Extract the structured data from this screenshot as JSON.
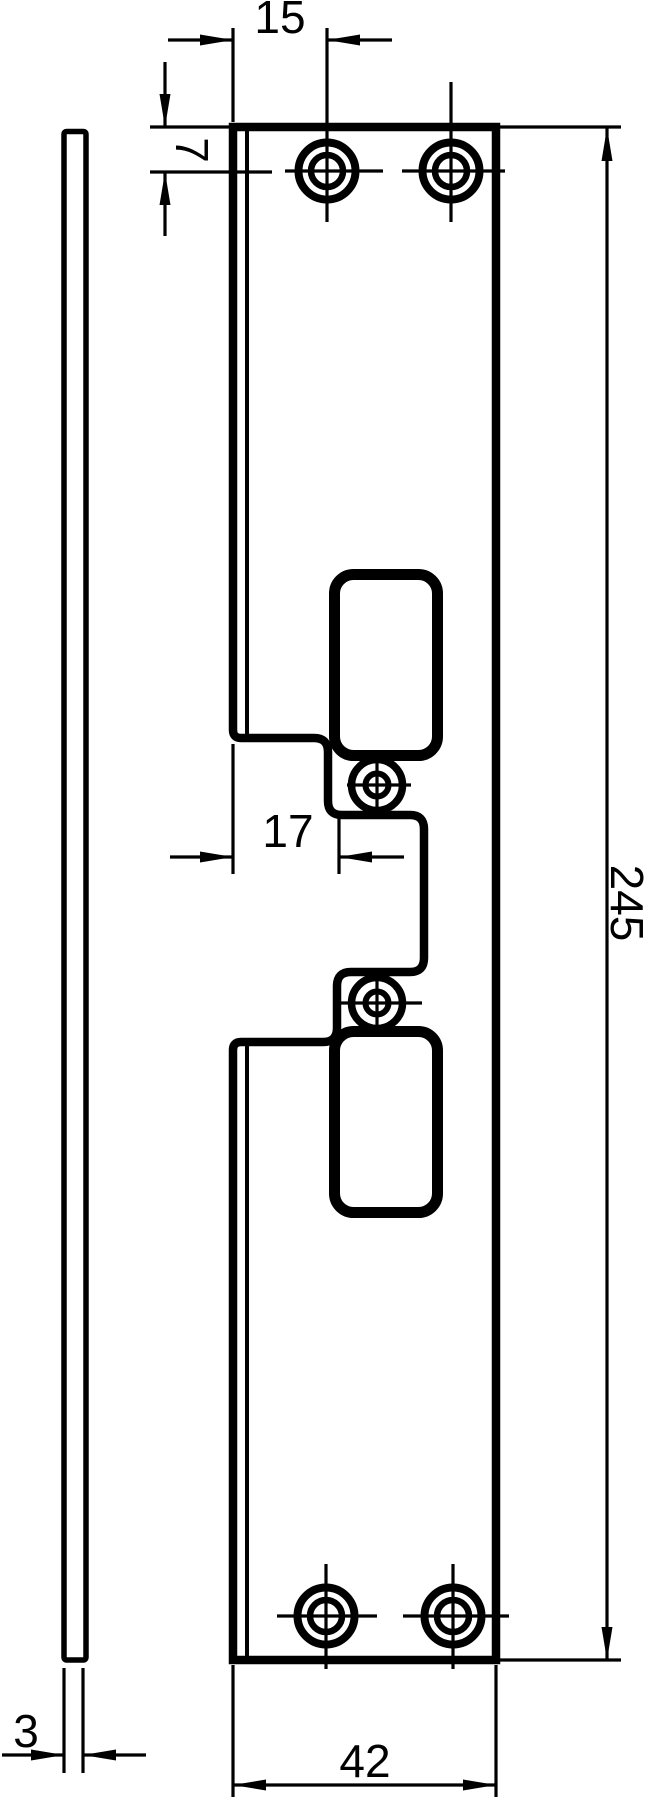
{
  "drawing": {
    "type": "technical-dimension-drawing",
    "subject": "strike-plate with latch cutouts, side and front view",
    "colors": {
      "line": "#000000",
      "background": "#ffffff"
    },
    "views": [
      "side-view",
      "front-view"
    ]
  },
  "labels": {
    "hole_offset_from_left": "15",
    "hole_offset_from_top": "7",
    "notch_width": "17",
    "plate_height": "245",
    "plate_width": "42",
    "plate_thickness": "3"
  }
}
